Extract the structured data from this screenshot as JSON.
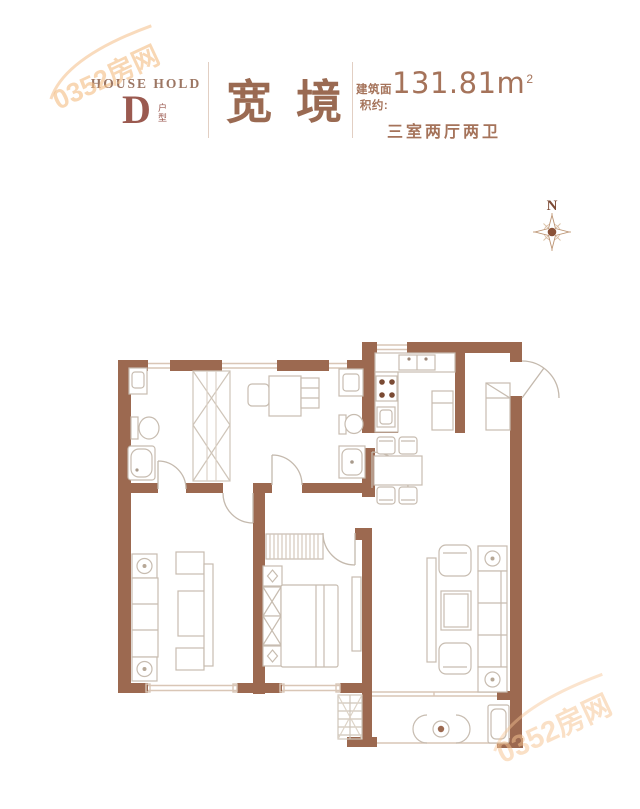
{
  "header": {
    "brand_en": "HOUSE HOLD",
    "unit_letter": "D",
    "unit_label": "户型",
    "title": "宽境",
    "area_prefix": "建筑面积约:",
    "area_value": "131.81m",
    "area_sup": "2",
    "layout": "三室两厅两卫"
  },
  "compass": {
    "label": "N"
  },
  "watermark": {
    "text": "0352房网"
  },
  "colors": {
    "wall": "#9c6950",
    "accent_text": "#9a6a52",
    "fixture_line": "#c7bcb0",
    "window_line": "#d9c6b6",
    "watermark": "#f4be86"
  }
}
